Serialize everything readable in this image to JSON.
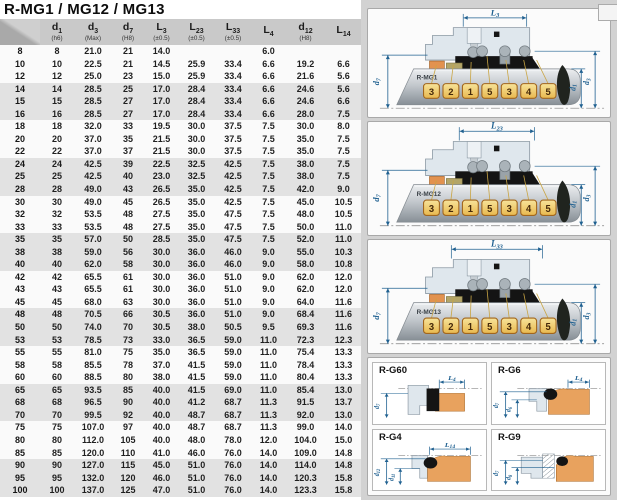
{
  "title": "R-MG1 / MG12 / MG13",
  "colors": {
    "dim": "#1f6090",
    "housing": "#dfe7ed",
    "housing_stroke": "#8b98a3",
    "collar": "#e2924f",
    "olive": "#b3a567",
    "black_part": "#141414",
    "seat_orange": "#e8a25e",
    "box_fill_top": "#f7e39a",
    "box_fill_bottom": "#e8b84e",
    "box_stroke": "#a2661d",
    "box_text": "#45290a",
    "shaft_light": "#eceef0",
    "shaft_mid": "#c3c8cd",
    "shaft_dark": "#878f96"
  },
  "table": {
    "headers": [
      {
        "main": "",
        "sub": "",
        "note": ""
      },
      {
        "main": "d",
        "sub": "1",
        "note": "(h6)"
      },
      {
        "main": "d",
        "sub": "3",
        "note": "(Max)"
      },
      {
        "main": "d",
        "sub": "7",
        "note": "(H8)"
      },
      {
        "main": "L",
        "sub": "3",
        "note": "(±0.5)"
      },
      {
        "main": "L",
        "sub": "23",
        "note": "(±0.5)"
      },
      {
        "main": "L",
        "sub": "33",
        "note": "(±0.5)"
      },
      {
        "main": "L",
        "sub": "4",
        "note": ""
      },
      {
        "main": "d",
        "sub": "12",
        "note": "(H8)"
      },
      {
        "main": "L",
        "sub": "14",
        "note": ""
      }
    ],
    "rows": [
      [
        "8",
        "8",
        "21.0",
        "21",
        "14.0",
        "",
        "",
        "6.0",
        "",
        ""
      ],
      [
        "10",
        "10",
        "22.5",
        "21",
        "14.5",
        "25.9",
        "33.4",
        "6.6",
        "19.2",
        "6.6"
      ],
      [
        "12",
        "12",
        "25.0",
        "23",
        "15.0",
        "25.9",
        "33.4",
        "6.6",
        "21.6",
        "5.6"
      ],
      [
        "14",
        "14",
        "28.5",
        "25",
        "17.0",
        "28.4",
        "33.4",
        "6.6",
        "24.6",
        "5.6"
      ],
      [
        "15",
        "15",
        "28.5",
        "27",
        "17.0",
        "28.4",
        "33.4",
        "6.6",
        "24.6",
        "6.6"
      ],
      [
        "16",
        "16",
        "28.5",
        "27",
        "17.0",
        "28.4",
        "33.4",
        "6.6",
        "28.0",
        "7.5"
      ],
      [
        "18",
        "18",
        "32.0",
        "33",
        "19.5",
        "30.0",
        "37.5",
        "7.5",
        "30.0",
        "8.0"
      ],
      [
        "20",
        "20",
        "37.0",
        "35",
        "21.5",
        "30.0",
        "37.5",
        "7.5",
        "35.0",
        "7.5"
      ],
      [
        "22",
        "22",
        "37.0",
        "37",
        "21.5",
        "30.0",
        "37.5",
        "7.5",
        "35.0",
        "7.5"
      ],
      [
        "24",
        "24",
        "42.5",
        "39",
        "22.5",
        "32.5",
        "42.5",
        "7.5",
        "38.0",
        "7.5"
      ],
      [
        "25",
        "25",
        "42.5",
        "40",
        "23.0",
        "32.5",
        "42.5",
        "7.5",
        "38.0",
        "7.5"
      ],
      [
        "28",
        "28",
        "49.0",
        "43",
        "26.5",
        "35.0",
        "42.5",
        "7.5",
        "42.0",
        "9.0"
      ],
      [
        "30",
        "30",
        "49.0",
        "45",
        "26.5",
        "35.0",
        "42.5",
        "7.5",
        "45.0",
        "10.5"
      ],
      [
        "32",
        "32",
        "53.5",
        "48",
        "27.5",
        "35.0",
        "47.5",
        "7.5",
        "48.0",
        "10.5"
      ],
      [
        "33",
        "33",
        "53.5",
        "48",
        "27.5",
        "35.0",
        "47.5",
        "7.5",
        "50.0",
        "11.0"
      ],
      [
        "35",
        "35",
        "57.0",
        "50",
        "28.5",
        "35.0",
        "47.5",
        "7.5",
        "52.0",
        "11.0"
      ],
      [
        "38",
        "38",
        "59.0",
        "56",
        "30.0",
        "36.0",
        "46.0",
        "9.0",
        "55.0",
        "10.3"
      ],
      [
        "40",
        "40",
        "62.0",
        "58",
        "30.0",
        "36.0",
        "46.0",
        "9.0",
        "58.0",
        "10.8"
      ],
      [
        "42",
        "42",
        "65.5",
        "61",
        "30.0",
        "36.0",
        "51.0",
        "9.0",
        "62.0",
        "12.0"
      ],
      [
        "43",
        "43",
        "65.5",
        "61",
        "30.0",
        "36.0",
        "51.0",
        "9.0",
        "62.0",
        "12.0"
      ],
      [
        "45",
        "45",
        "68.0",
        "63",
        "30.0",
        "36.0",
        "51.0",
        "9.0",
        "64.0",
        "11.6"
      ],
      [
        "48",
        "48",
        "70.5",
        "66",
        "30.5",
        "36.0",
        "51.0",
        "9.0",
        "68.4",
        "11.6"
      ],
      [
        "50",
        "50",
        "74.0",
        "70",
        "30.5",
        "38.0",
        "50.5",
        "9.5",
        "69.3",
        "11.6"
      ],
      [
        "53",
        "53",
        "78.5",
        "73",
        "33.0",
        "36.5",
        "59.0",
        "11.0",
        "72.3",
        "12.3"
      ],
      [
        "55",
        "55",
        "81.0",
        "75",
        "35.0",
        "36.5",
        "59.0",
        "11.0",
        "75.4",
        "13.3"
      ],
      [
        "58",
        "58",
        "85.5",
        "78",
        "37.0",
        "41.5",
        "59.0",
        "11.0",
        "78.4",
        "13.3"
      ],
      [
        "60",
        "60",
        "88.5",
        "80",
        "38.0",
        "41.5",
        "59.0",
        "11.0",
        "80.4",
        "13.3"
      ],
      [
        "65",
        "65",
        "93.5",
        "85",
        "40.0",
        "41.5",
        "69.0",
        "11.0",
        "85.4",
        "13.0"
      ],
      [
        "68",
        "68",
        "96.5",
        "90",
        "40.0",
        "41.2",
        "68.7",
        "11.3",
        "91.5",
        "13.7"
      ],
      [
        "70",
        "70",
        "99.5",
        "92",
        "40.0",
        "48.7",
        "68.7",
        "11.3",
        "92.0",
        "13.0"
      ],
      [
        "75",
        "75",
        "107.0",
        "97",
        "40.0",
        "48.7",
        "68.7",
        "11.3",
        "99.0",
        "14.0"
      ],
      [
        "80",
        "80",
        "112.0",
        "105",
        "40.0",
        "48.0",
        "78.0",
        "12.0",
        "104.0",
        "15.0"
      ],
      [
        "85",
        "85",
        "120.0",
        "110",
        "41.0",
        "46.0",
        "76.0",
        "14.0",
        "109.0",
        "14.8"
      ],
      [
        "90",
        "90",
        "127.0",
        "115",
        "45.0",
        "51.0",
        "76.0",
        "14.0",
        "114.0",
        "14.8"
      ],
      [
        "95",
        "95",
        "132.0",
        "120",
        "46.0",
        "51.0",
        "76.0",
        "14.0",
        "120.3",
        "15.8"
      ],
      [
        "100",
        "100",
        "137.0",
        "125",
        "47.0",
        "51.0",
        "76.0",
        "14.0",
        "123.3",
        "15.8"
      ]
    ]
  },
  "diagrams": [
    {
      "model": "R-MG1",
      "dim": {
        "main": "L",
        "sub": "3"
      },
      "left_dim": {
        "main": "d",
        "sub": "7"
      },
      "right_dims": [
        {
          "main": "d",
          "sub": "1"
        },
        {
          "main": "d",
          "sub": "3"
        }
      ],
      "numbers": [
        "3",
        "2",
        "1",
        "5",
        "3",
        "4",
        "5"
      ]
    },
    {
      "model": "R-MG12",
      "dim": {
        "main": "L",
        "sub": "23"
      },
      "left_dim": {
        "main": "d",
        "sub": "7"
      },
      "right_dims": [
        {
          "main": "d",
          "sub": "1"
        },
        {
          "main": "d",
          "sub": "3"
        }
      ],
      "numbers": [
        "3",
        "2",
        "1",
        "5",
        "3",
        "4",
        "5"
      ]
    },
    {
      "model": "R-MG13",
      "dim": {
        "main": "L",
        "sub": "33"
      },
      "left_dim": {
        "main": "d",
        "sub": "7"
      },
      "right_dims": [
        {
          "main": "d",
          "sub": "1"
        },
        {
          "main": "d",
          "sub": "3"
        }
      ],
      "numbers": [
        "3",
        "2",
        "1",
        "5",
        "3",
        "4",
        "5"
      ]
    }
  ],
  "seats": [
    {
      "label": "R-G60",
      "dim": {
        "main": "L",
        "sub": "4"
      },
      "dias": [
        {
          "main": "d",
          "sub": "7"
        }
      ]
    },
    {
      "label": "R-G6",
      "dim": {
        "main": "L",
        "sub": "4"
      },
      "dias": [
        {
          "main": "d",
          "sub": "7"
        },
        {
          "main": "d",
          "sub": "6"
        }
      ]
    },
    {
      "label": "R-G4",
      "dim": {
        "main": "L",
        "sub": "14"
      },
      "dias": [
        {
          "main": "d",
          "sub": "12"
        },
        {
          "main": "d",
          "sub": "11"
        }
      ]
    },
    {
      "label": "R-G9",
      "dim": null,
      "dias": [
        {
          "main": "d",
          "sub": "7"
        },
        {
          "main": "d",
          "sub": "8"
        }
      ]
    }
  ]
}
